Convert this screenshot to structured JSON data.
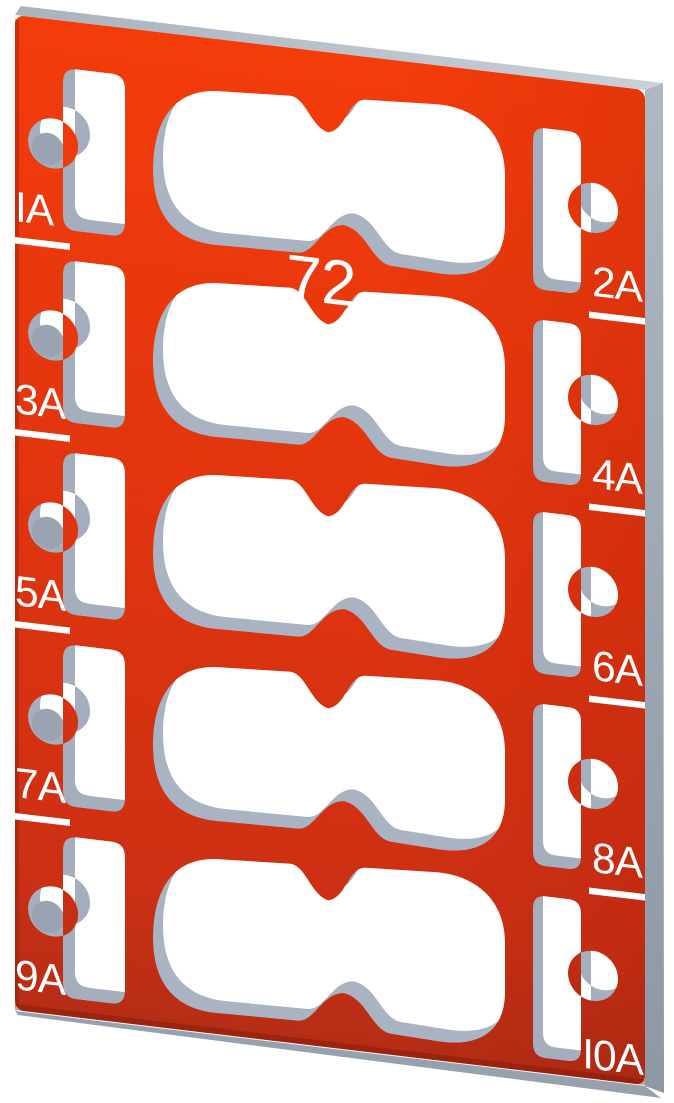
{
  "plate": {
    "type_label": "marker plate render",
    "center_label": "72",
    "left_labels": [
      "IA",
      "3A",
      "5A",
      "7A",
      "9A"
    ],
    "right_labels": [
      "2A",
      "4A",
      "6A",
      "8A",
      "I0A"
    ],
    "colors": {
      "red_top": "#f43c0b",
      "red_mid": "#e0340f",
      "red_lower": "#cd3013",
      "red_bottom": "#b52d16",
      "edge_top_light": "#c9d0d8",
      "edge_top_dark": "#aab3bd",
      "edge_right_top": "#aeb7c2",
      "edge_right_bottom": "#8e98a4",
      "edge_bottom": "#97a1ad",
      "inner_wall": "#a4aebc",
      "inner_wall_deep": "#99a3b1",
      "label": "#ffffff",
      "background": "#ffffff"
    }
  }
}
